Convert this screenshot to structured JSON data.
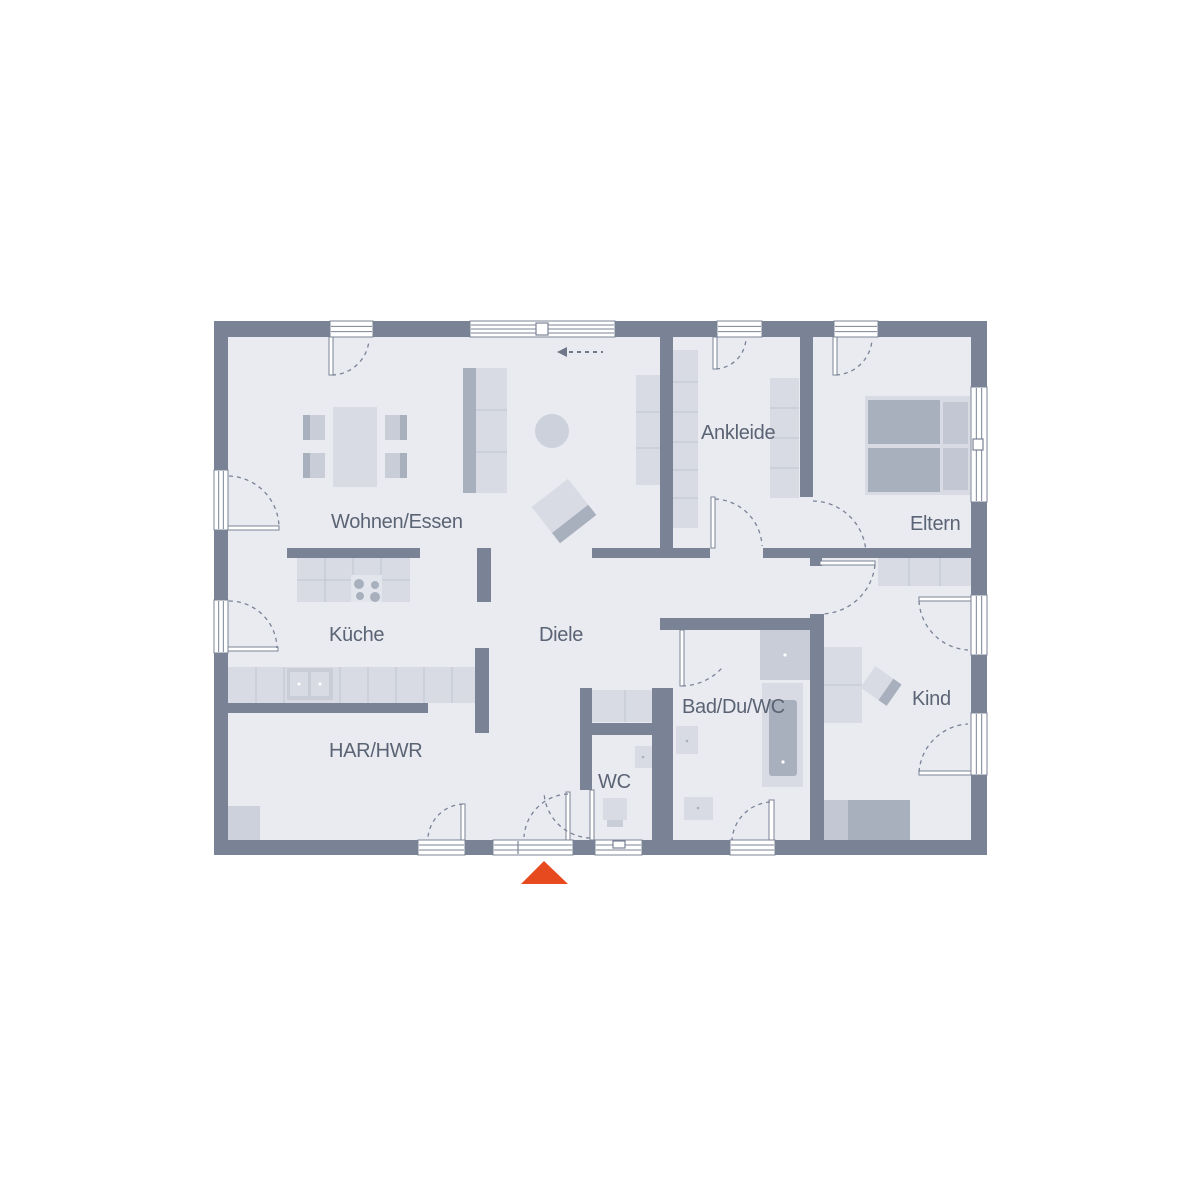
{
  "canvas": {
    "width": 1200,
    "height": 1200,
    "background": "#ffffff"
  },
  "colors": {
    "wall": "#7a8396",
    "floor": "#e9ebf1",
    "white": "#ffffff",
    "light": "#d8dbe4",
    "mid": "#c9cdd7",
    "dark": "#a9b0bd",
    "pillow": "#c2c7d3",
    "rug": "#ccd1db",
    "hob": "#e2e5eb",
    "divline": "#bfc4cf",
    "label": "#5b6474",
    "accent": "#e84a1f",
    "arrow": "#6f7888"
  },
  "rooms": [
    {
      "id": "wohnen-essen",
      "label": "Wohnen/Essen",
      "x": 331,
      "y": 528
    },
    {
      "id": "kueche",
      "label": "Küche",
      "x": 329,
      "y": 641
    },
    {
      "id": "diele",
      "label": "Diele",
      "x": 539,
      "y": 641
    },
    {
      "id": "har-hwr",
      "label": "HAR/HWR",
      "x": 329,
      "y": 757
    },
    {
      "id": "wc",
      "label": "WC",
      "x": 598,
      "y": 788
    },
    {
      "id": "bad-du-wc",
      "label": "Bad/Du/WC",
      "x": 682,
      "y": 713
    },
    {
      "id": "kind",
      "label": "Kind",
      "x": 912,
      "y": 705
    },
    {
      "id": "eltern",
      "label": "Eltern",
      "x": 910,
      "y": 530
    },
    {
      "id": "ankleide",
      "label": "Ankleide",
      "x": 701,
      "y": 439
    }
  ],
  "structure": {
    "floor": {
      "x": 228,
      "y": 337,
      "w": 743,
      "h": 503
    },
    "walls": [
      [
        214,
        321,
        773,
        16
      ],
      [
        214,
        321,
        14,
        534
      ],
      [
        971,
        321,
        16,
        534
      ],
      [
        214,
        840,
        773,
        15
      ],
      [
        660,
        337,
        13,
        211
      ],
      [
        800,
        337,
        13,
        160
      ],
      [
        592,
        548,
        118,
        10
      ],
      [
        763,
        548,
        208,
        10
      ],
      [
        287,
        548,
        133,
        10
      ],
      [
        477,
        548,
        14,
        54
      ],
      [
        475,
        648,
        14,
        85
      ],
      [
        228,
        703,
        200,
        10
      ],
      [
        810,
        558,
        12,
        8
      ],
      [
        810,
        614,
        14,
        226
      ],
      [
        660,
        618,
        153,
        12
      ],
      [
        652,
        688,
        21,
        152
      ],
      [
        580,
        723,
        83,
        12
      ],
      [
        580,
        688,
        12,
        102
      ]
    ],
    "windows": [
      {
        "x": 330,
        "y": 321,
        "w": 43,
        "h": 16,
        "axis": "h",
        "lines": 2,
        "name": "window-wohnen-top"
      },
      {
        "x": 470,
        "y": 321,
        "w": 145,
        "h": 16,
        "axis": "h",
        "lines": 3,
        "name": "sliding-terrace-door"
      },
      {
        "x": 717,
        "y": 321,
        "w": 45,
        "h": 16,
        "axis": "h",
        "lines": 2,
        "name": "window-ankleide-top"
      },
      {
        "x": 834,
        "y": 321,
        "w": 44,
        "h": 16,
        "axis": "h",
        "lines": 2,
        "name": "window-eltern-top"
      },
      {
        "x": 214,
        "y": 470,
        "w": 14,
        "h": 60,
        "axis": "v",
        "lines": 2,
        "name": "window-wohnen-left"
      },
      {
        "x": 214,
        "y": 600,
        "w": 14,
        "h": 53,
        "axis": "v",
        "lines": 2,
        "name": "window-kueche-left"
      },
      {
        "x": 971,
        "y": 387,
        "w": 16,
        "h": 115,
        "axis": "v",
        "lines": 2,
        "name": "window-eltern-right"
      },
      {
        "x": 971,
        "y": 595,
        "w": 16,
        "h": 60,
        "axis": "v",
        "lines": 2,
        "name": "window-kind-right-1"
      },
      {
        "x": 971,
        "y": 713,
        "w": 16,
        "h": 62,
        "axis": "v",
        "lines": 2,
        "name": "window-kind-right-2"
      },
      {
        "x": 418,
        "y": 840,
        "w": 47,
        "h": 15,
        "axis": "h",
        "lines": 2,
        "name": "door-har-exterior"
      },
      {
        "x": 493,
        "y": 840,
        "w": 80,
        "h": 15,
        "axis": "h",
        "lines": 2,
        "name": "door-main-entrance"
      },
      {
        "x": 595,
        "y": 840,
        "w": 47,
        "h": 15,
        "axis": "h",
        "lines": 2,
        "name": "window-wc-bottom"
      },
      {
        "x": 730,
        "y": 840,
        "w": 45,
        "h": 15,
        "axis": "h",
        "lines": 2,
        "name": "window-bad-bottom"
      }
    ],
    "window_accents": [
      {
        "x": 536,
        "y": 323,
        "w": 12,
        "h": 12,
        "name": "sliding-door-handle"
      },
      {
        "x": 973,
        "y": 439,
        "w": 10,
        "h": 11,
        "name": "window-handle"
      },
      {
        "x": 613,
        "y": 841,
        "w": 12,
        "h": 7,
        "name": "window-vent-mark"
      }
    ],
    "divider_lines": [
      {
        "x1": 518,
        "y1": 841,
        "x2": 518,
        "y2": 854,
        "name": "entrance-sidelight-divider"
      }
    ],
    "door_leaves": [
      [
        329,
        337,
        4,
        38
      ],
      [
        713,
        337,
        4,
        32
      ],
      [
        833,
        337,
        4,
        38
      ],
      [
        228,
        526,
        51,
        4
      ],
      [
        228,
        647,
        50,
        4
      ],
      [
        919,
        597,
        52,
        4
      ],
      [
        919,
        771,
        52,
        4
      ],
      [
        769,
        800,
        5,
        40
      ],
      [
        711,
        497,
        4,
        51
      ],
      [
        820,
        561,
        55,
        4
      ],
      [
        680,
        630,
        4,
        56
      ],
      [
        590,
        790,
        4,
        50
      ],
      [
        461,
        804,
        4,
        36
      ],
      [
        566,
        792,
        4,
        48
      ]
    ],
    "swing_arcs": [
      "M332 375 A38 38 0 0 0 369 340",
      "M716 369 A32 32 0 0 0 746 339",
      "M836 375 A38 38 0 0 0 872 340",
      "M229 476 A52 52 0 0 1 279 527",
      "M229 601 A48 48 0 0 1 277 648",
      "M919 601 A52 52 0 0 0 968 650",
      "M919 772 A52 52 0 0 1 968 724",
      "M770 802 A41 41 0 0 0 732 840",
      "M715 499 A49 49 0 0 1 762 546",
      "M875 565 A55 55 0 0 1 822 614",
      "M813 501 A54 54 0 0 1 866 554",
      "M682 686 A56 56 0 0 0 722 668",
      "M590 838 A48 48 0 0 1 544 792",
      "M463 804 A37 37 0 0 0 428 837",
      "M568 794 A46 46 0 0 0 524 837"
    ]
  },
  "furniture": [
    {
      "t": "rect",
      "n": "dining-table",
      "x": 333,
      "y": 407,
      "w": 44,
      "h": 80,
      "f": "light"
    },
    {
      "t": "rect",
      "n": "chair",
      "x": 303,
      "y": 415,
      "w": 22,
      "h": 25,
      "f": "mid"
    },
    {
      "t": "rect",
      "n": "chair-back",
      "x": 303,
      "y": 415,
      "w": 7,
      "h": 25,
      "f": "dark"
    },
    {
      "t": "rect",
      "n": "chair",
      "x": 303,
      "y": 453,
      "w": 22,
      "h": 25,
      "f": "mid"
    },
    {
      "t": "rect",
      "n": "chair-back",
      "x": 303,
      "y": 453,
      "w": 7,
      "h": 25,
      "f": "dark"
    },
    {
      "t": "rect",
      "n": "chair",
      "x": 385,
      "y": 415,
      "w": 22,
      "h": 25,
      "f": "mid"
    },
    {
      "t": "rect",
      "n": "chair-back",
      "x": 400,
      "y": 415,
      "w": 7,
      "h": 25,
      "f": "dark"
    },
    {
      "t": "rect",
      "n": "chair",
      "x": 385,
      "y": 453,
      "w": 22,
      "h": 25,
      "f": "mid"
    },
    {
      "t": "rect",
      "n": "chair-back",
      "x": 400,
      "y": 453,
      "w": 7,
      "h": 25,
      "f": "dark"
    },
    {
      "t": "rect",
      "n": "sofa",
      "x": 463,
      "y": 368,
      "w": 44,
      "h": 125,
      "f": "light"
    },
    {
      "t": "rect",
      "n": "sofa-back",
      "x": 463,
      "y": 368,
      "w": 13,
      "h": 125,
      "f": "dark"
    },
    {
      "t": "line",
      "x1": 476,
      "y1": 410,
      "x2": 507,
      "y2": 410,
      "s": "divline"
    },
    {
      "t": "line",
      "x1": 476,
      "y1": 452,
      "x2": 507,
      "y2": 452,
      "s": "divline"
    },
    {
      "t": "rect",
      "n": "shelf-unit",
      "x": 636,
      "y": 375,
      "w": 24,
      "h": 110,
      "f": "light"
    },
    {
      "t": "line",
      "x1": 636,
      "y1": 412,
      "x2": 660,
      "y2": 412,
      "s": "divline"
    },
    {
      "t": "line",
      "x1": 636,
      "y1": 448,
      "x2": 660,
      "y2": 448,
      "s": "divline"
    },
    {
      "t": "circle",
      "n": "round-rug",
      "cx": 552,
      "cy": 431,
      "r": 17,
      "f": "rug"
    },
    {
      "t": "g",
      "n": "armchair",
      "tx": 564,
      "ty": 511,
      "rot": -38,
      "items": [
        {
          "t": "rect",
          "x": -23,
          "y": -23,
          "w": 46,
          "h": 46,
          "f": "light"
        },
        {
          "t": "rect",
          "x": -23,
          "y": 10,
          "w": 46,
          "h": 13,
          "f": "dark"
        }
      ]
    },
    {
      "t": "rect",
      "n": "kitchen-island",
      "x": 297,
      "y": 558,
      "w": 113,
      "h": 44,
      "f": "light"
    },
    {
      "t": "line",
      "x1": 325,
      "y1": 558,
      "x2": 325,
      "y2": 602,
      "s": "divline"
    },
    {
      "t": "line",
      "x1": 353,
      "y1": 558,
      "x2": 353,
      "y2": 602,
      "s": "divline"
    },
    {
      "t": "line",
      "x1": 381,
      "y1": 558,
      "x2": 381,
      "y2": 602,
      "s": "divline"
    },
    {
      "t": "line",
      "x1": 297,
      "y1": 580,
      "x2": 410,
      "y2": 580,
      "s": "divline"
    },
    {
      "t": "rect",
      "n": "cooktop",
      "x": 351,
      "y": 575,
      "w": 31,
      "h": 27,
      "f": "hob"
    },
    {
      "t": "circle",
      "n": "burner",
      "cx": 359,
      "cy": 584,
      "r": 5,
      "f": "dark"
    },
    {
      "t": "circle",
      "n": "burner",
      "cx": 375,
      "cy": 585,
      "r": 4,
      "f": "dark"
    },
    {
      "t": "circle",
      "n": "burner",
      "cx": 360,
      "cy": 596,
      "r": 4,
      "f": "dark"
    },
    {
      "t": "circle",
      "n": "burner",
      "cx": 375,
      "cy": 597,
      "r": 5,
      "f": "dark"
    },
    {
      "t": "rect",
      "n": "kitchen-counter",
      "x": 228,
      "y": 667,
      "w": 249,
      "h": 36,
      "f": "light"
    },
    {
      "t": "line",
      "x1": 256,
      "y1": 667,
      "x2": 256,
      "y2": 703,
      "s": "divline"
    },
    {
      "t": "line",
      "x1": 284,
      "y1": 667,
      "x2": 284,
      "y2": 703,
      "s": "divline"
    },
    {
      "t": "line",
      "x1": 340,
      "y1": 667,
      "x2": 340,
      "y2": 703,
      "s": "divline"
    },
    {
      "t": "line",
      "x1": 368,
      "y1": 667,
      "x2": 368,
      "y2": 703,
      "s": "divline"
    },
    {
      "t": "line",
      "x1": 396,
      "y1": 667,
      "x2": 396,
      "y2": 703,
      "s": "divline"
    },
    {
      "t": "line",
      "x1": 424,
      "y1": 667,
      "x2": 424,
      "y2": 703,
      "s": "divline"
    },
    {
      "t": "line",
      "x1": 452,
      "y1": 667,
      "x2": 452,
      "y2": 703,
      "s": "divline"
    },
    {
      "t": "rect",
      "n": "sink",
      "x": 287,
      "y": 668,
      "w": 46,
      "h": 32,
      "f": "mid"
    },
    {
      "t": "rect",
      "n": "sink-bowl",
      "x": 290,
      "y": 672,
      "w": 18,
      "h": 24,
      "f": "light"
    },
    {
      "t": "rect",
      "n": "sink-bowl",
      "x": 311,
      "y": 672,
      "w": 18,
      "h": 24,
      "f": "light"
    },
    {
      "t": "circle",
      "n": "sink-drain",
      "cx": 299,
      "cy": 684,
      "r": 1.5,
      "f": "white"
    },
    {
      "t": "circle",
      "n": "sink-drain",
      "cx": 320,
      "cy": 684,
      "r": 1.5,
      "f": "white"
    },
    {
      "t": "rect",
      "n": "har-cabinet",
      "x": 228,
      "y": 806,
      "w": 32,
      "h": 34,
      "f": "rug"
    },
    {
      "t": "rect",
      "n": "diele-sideboard",
      "x": 592,
      "y": 690,
      "w": 66,
      "h": 32,
      "f": "light"
    },
    {
      "t": "line",
      "x1": 625,
      "y1": 690,
      "x2": 625,
      "y2": 722,
      "s": "divline"
    },
    {
      "t": "rect",
      "n": "wc-basin",
      "x": 635,
      "y": 746,
      "w": 17,
      "h": 22,
      "f": "light"
    },
    {
      "t": "circle",
      "n": "basin-drain",
      "cx": 643,
      "cy": 757,
      "r": 1.3,
      "f": "dark"
    },
    {
      "t": "rect",
      "n": "toilet",
      "x": 603,
      "y": 798,
      "w": 24,
      "h": 22,
      "f": "light"
    },
    {
      "t": "rect",
      "n": "toilet-seat",
      "x": 607,
      "y": 820,
      "w": 16,
      "h": 7,
      "f": "mid"
    },
    {
      "t": "rect",
      "n": "shower",
      "x": 760,
      "y": 630,
      "w": 50,
      "h": 50,
      "f": "mid"
    },
    {
      "t": "circle",
      "n": "shower-drain",
      "cx": 785,
      "cy": 655,
      "r": 1.6,
      "f": "white"
    },
    {
      "t": "rect",
      "n": "bathtub",
      "x": 762,
      "y": 683,
      "w": 41,
      "h": 104,
      "f": "light"
    },
    {
      "t": "rect",
      "n": "bathtub-inner",
      "x": 769,
      "y": 700,
      "w": 28,
      "h": 76,
      "f": "dark",
      "rx": 3
    },
    {
      "t": "circle",
      "n": "tub-drain",
      "cx": 783,
      "cy": 762,
      "r": 1.6,
      "f": "white"
    },
    {
      "t": "rect",
      "n": "bath-basin",
      "x": 676,
      "y": 726,
      "w": 22,
      "h": 28,
      "f": "light"
    },
    {
      "t": "circle",
      "n": "basin-drain",
      "cx": 687,
      "cy": 741,
      "r": 1.3,
      "f": "dark"
    },
    {
      "t": "rect",
      "n": "bath-basin",
      "x": 684,
      "y": 797,
      "w": 29,
      "h": 23,
      "f": "light"
    },
    {
      "t": "circle",
      "n": "basin-drain",
      "cx": 698,
      "cy": 808,
      "r": 1.3,
      "f": "dark"
    },
    {
      "t": "rect",
      "n": "kind-wardrobe",
      "x": 878,
      "y": 558,
      "w": 93,
      "h": 28,
      "f": "light"
    },
    {
      "t": "line",
      "x1": 909,
      "y1": 558,
      "x2": 909,
      "y2": 586,
      "s": "divline"
    },
    {
      "t": "line",
      "x1": 940,
      "y1": 558,
      "x2": 940,
      "y2": 586,
      "s": "divline"
    },
    {
      "t": "rect",
      "n": "kind-shelf",
      "x": 824,
      "y": 647,
      "w": 38,
      "h": 76,
      "f": "light"
    },
    {
      "t": "line",
      "x1": 824,
      "y1": 685,
      "x2": 862,
      "y2": 685,
      "s": "divline"
    },
    {
      "t": "g",
      "n": "kind-desk",
      "tx": 881,
      "ty": 686,
      "rot": 35,
      "items": [
        {
          "t": "rect",
          "x": -16,
          "y": -13,
          "w": 32,
          "h": 26,
          "f": "light"
        },
        {
          "t": "rect",
          "x": 6,
          "y": -13,
          "w": 10,
          "h": 26,
          "f": "dark"
        }
      ]
    },
    {
      "t": "rect",
      "n": "kind-bed",
      "x": 822,
      "y": 800,
      "w": 88,
      "h": 40,
      "f": "pillow"
    },
    {
      "t": "rect",
      "n": "kind-bed-mattress",
      "x": 848,
      "y": 800,
      "w": 62,
      "h": 40,
      "f": "dark"
    },
    {
      "t": "rect",
      "n": "eltern-bed",
      "x": 865,
      "y": 396,
      "w": 105,
      "h": 99,
      "f": "light"
    },
    {
      "t": "rect",
      "n": "eltern-mattress",
      "x": 868,
      "y": 400,
      "w": 72,
      "h": 44,
      "f": "dark"
    },
    {
      "t": "rect",
      "n": "eltern-mattress",
      "x": 868,
      "y": 448,
      "w": 72,
      "h": 44,
      "f": "dark"
    },
    {
      "t": "rect",
      "n": "eltern-pillow",
      "x": 943,
      "y": 402,
      "w": 25,
      "h": 42,
      "f": "pillow"
    },
    {
      "t": "rect",
      "n": "eltern-pillow",
      "x": 943,
      "y": 448,
      "w": 25,
      "h": 42,
      "f": "pillow"
    },
    {
      "t": "rect",
      "n": "ankleide-wardrobe-west",
      "x": 668,
      "y": 350,
      "w": 30,
      "h": 178,
      "f": "light"
    },
    {
      "t": "line",
      "x1": 668,
      "y1": 382,
      "x2": 698,
      "y2": 382,
      "s": "divline"
    },
    {
      "t": "line",
      "x1": 668,
      "y1": 412,
      "x2": 698,
      "y2": 412,
      "s": "divline"
    },
    {
      "t": "line",
      "x1": 668,
      "y1": 442,
      "x2": 698,
      "y2": 442,
      "s": "divline"
    },
    {
      "t": "line",
      "x1": 668,
      "y1": 470,
      "x2": 698,
      "y2": 470,
      "s": "divline"
    },
    {
      "t": "line",
      "x1": 668,
      "y1": 498,
      "x2": 698,
      "y2": 498,
      "s": "divline"
    },
    {
      "t": "rect",
      "n": "ankleide-wardrobe-east",
      "x": 770,
      "y": 378,
      "w": 29,
      "h": 120,
      "f": "light"
    },
    {
      "t": "line",
      "x1": 770,
      "y1": 408,
      "x2": 799,
      "y2": 408,
      "s": "divline"
    },
    {
      "t": "line",
      "x1": 770,
      "y1": 438,
      "x2": 799,
      "y2": 438,
      "s": "divline"
    },
    {
      "t": "line",
      "x1": 770,
      "y1": 468,
      "x2": 799,
      "y2": 468,
      "s": "divline"
    }
  ],
  "symbols": {
    "entrance_marker": {
      "points": "521,884 568,884 544,861"
    },
    "sliding_arrow": {
      "triangle": "557,352 567,347 567,357",
      "line": {
        "x1": 569,
        "y1": 352,
        "x2": 603,
        "y2": 352
      }
    }
  }
}
